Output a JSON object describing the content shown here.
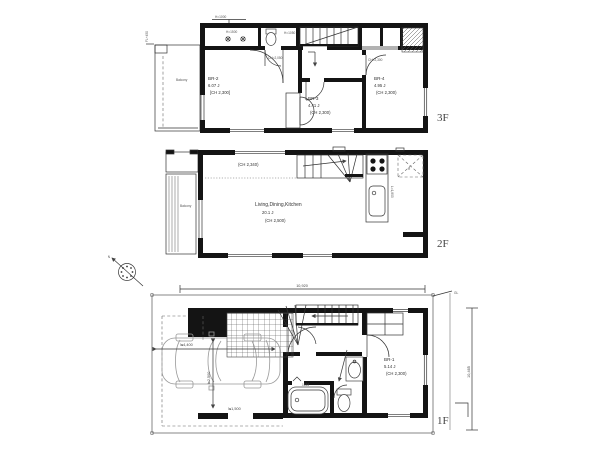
{
  "floor3": {
    "floor_label": "3F",
    "balcony": "Balcony",
    "h1000": "H=1000",
    "left_note": "FL+450",
    "wic_note": "H=1500",
    "wc_note": "H=1050",
    "hall_note": "CH=2,050",
    "r4_note": "CH=2,300",
    "rooms": {
      "br2": {
        "name": "BR-2",
        "area": "6.07 J",
        "ch": "[CH 2,300]"
      },
      "br3": {
        "name": "BR-3",
        "area": "4.41 J",
        "ch": "(CH 2,300)"
      },
      "br4": {
        "name": "BR-4",
        "area": "4.95 J",
        "ch": "(CH 2,300)"
      }
    }
  },
  "floor2": {
    "floor_label": "2F",
    "balcony": "Balcony",
    "ch_note": "(CH 2,340)",
    "ldk": {
      "name": "Living,Dining,Kitchen",
      "area": "20.1 J",
      "ch": "(CH 2,500)"
    },
    "fridge": "R",
    "counter_note": "L=1,800"
  },
  "floor1": {
    "floor_label": "1F",
    "room": {
      "name": "BR-1",
      "area": "5.14 J",
      "ch": "(CH 2,300)"
    },
    "bath_size": "1616",
    "dim_top": "10,920",
    "dim_right": "10,465",
    "dim_garage_w": "≒4,400",
    "dim_garage_d": "≒2,500",
    "dim_car": "≒1,500",
    "gl_note": "GL",
    "compass_n": "N"
  }
}
